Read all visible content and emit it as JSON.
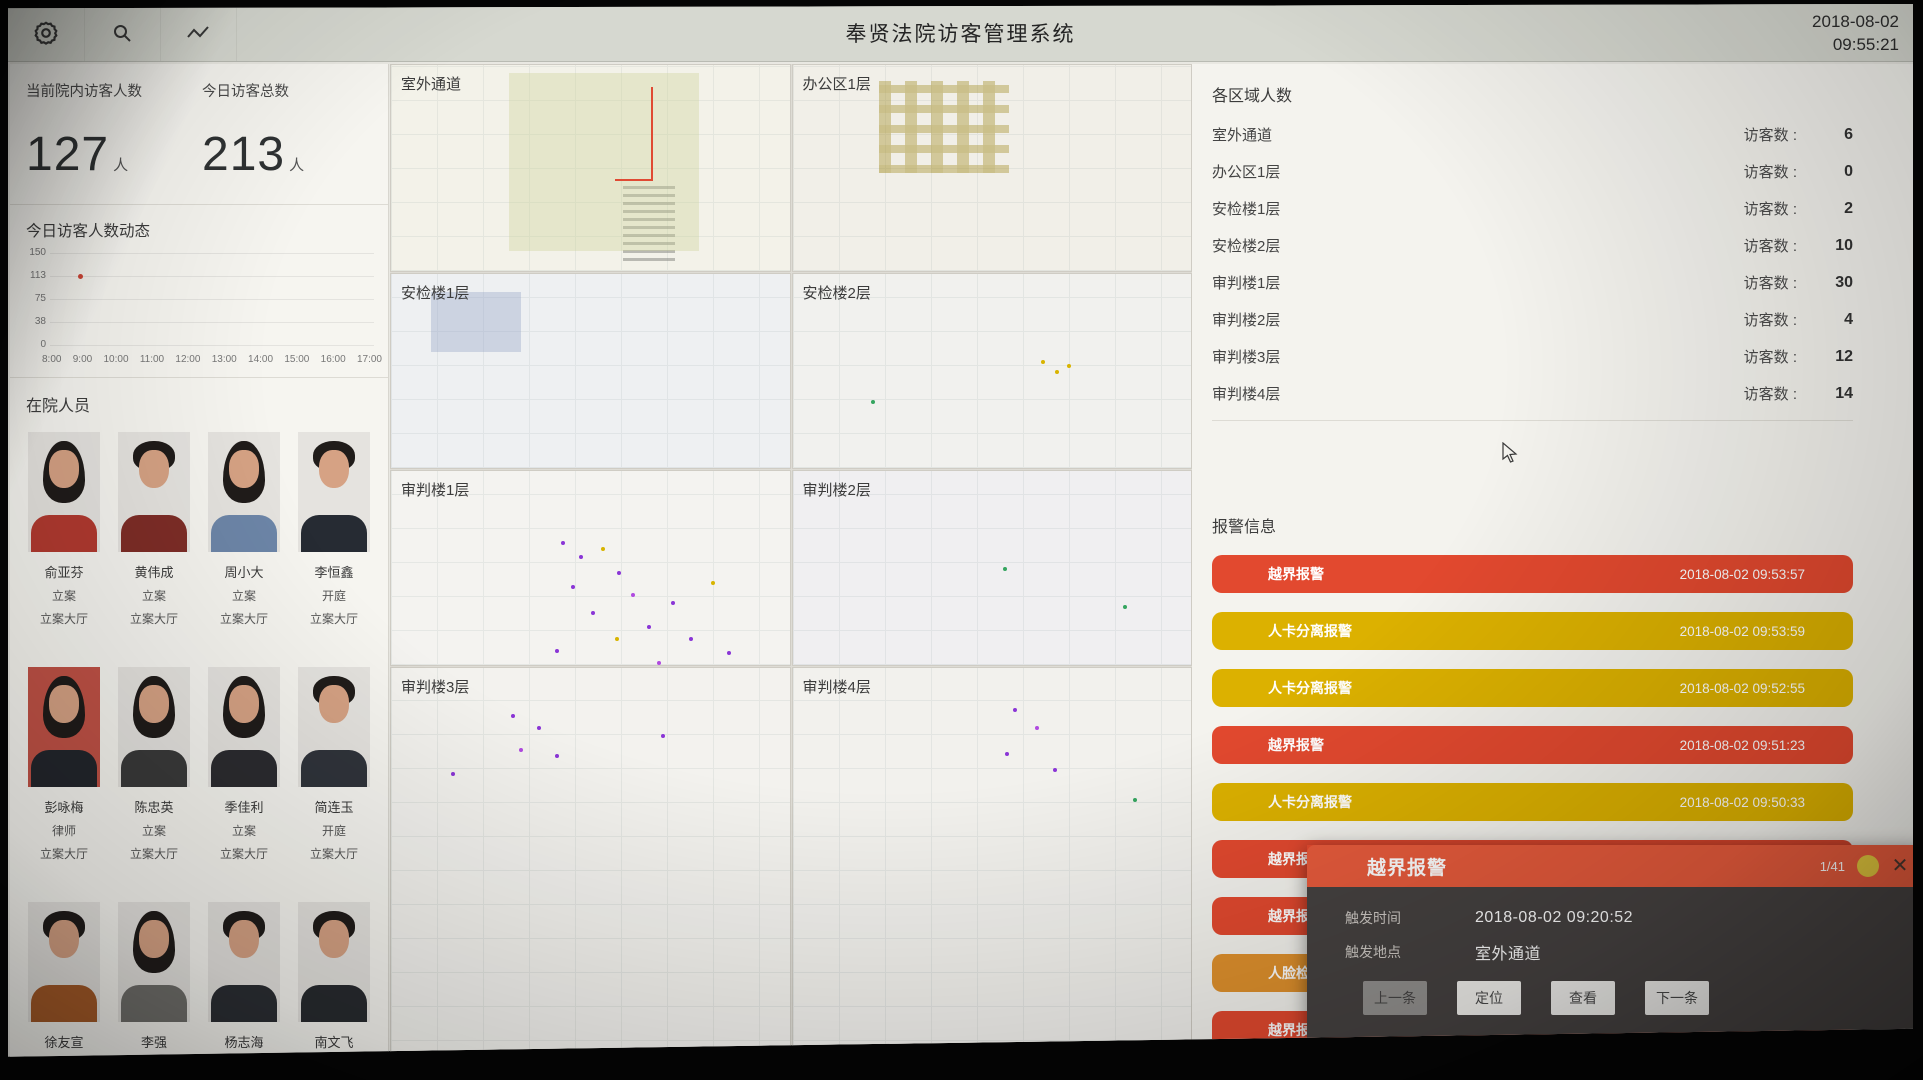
{
  "header": {
    "title": "奉贤法院访客管理系统",
    "date": "2018-08-02",
    "time": "09:55:21",
    "icons": [
      "settings-icon",
      "search-icon",
      "trend-icon"
    ]
  },
  "stats": {
    "current_label": "当前院内访客人数",
    "current_value": "127",
    "current_unit": "人",
    "today_label": "今日访客总数",
    "today_value": "213",
    "today_unit": "人"
  },
  "chart_data": {
    "type": "scatter",
    "title": "今日访客人数动态",
    "x_ticks": [
      "8:00",
      "9:00",
      "10:00",
      "11:00",
      "12:00",
      "13:00",
      "14:00",
      "15:00",
      "16:00",
      "17:00"
    ],
    "y_ticks": [
      "150",
      "113",
      "75",
      "38",
      "0"
    ],
    "ylim": [
      0,
      150
    ],
    "points": [
      {
        "x": "8:30",
        "y": 113
      }
    ],
    "grid": true,
    "legend": false
  },
  "personnel": {
    "title": "在院人员",
    "people": [
      {
        "name": "俞亚芬",
        "type": "立案",
        "location": "立案大厅"
      },
      {
        "name": "黄伟成",
        "type": "立案",
        "location": "立案大厅"
      },
      {
        "name": "周小大",
        "type": "立案",
        "location": "立案大厅"
      },
      {
        "name": "李恒鑫",
        "type": "开庭",
        "location": "立案大厅"
      },
      {
        "name": "彭咏梅",
        "type": "律师",
        "location": "立案大厅"
      },
      {
        "name": "陈忠英",
        "type": "立案",
        "location": "立案大厅"
      },
      {
        "name": "季佳利",
        "type": "立案",
        "location": "立案大厅"
      },
      {
        "name": "简连玉",
        "type": "开庭",
        "location": "立案大厅"
      },
      {
        "name": "徐友宣",
        "type": "立案",
        "location": ""
      },
      {
        "name": "李强",
        "type": "立案",
        "location": ""
      },
      {
        "name": "杨志海",
        "type": "开庭",
        "location": ""
      },
      {
        "name": "南文飞",
        "type": "立案",
        "location": ""
      }
    ]
  },
  "maps": {
    "panels": [
      {
        "label": "室外通道"
      },
      {
        "label": "办公区1层"
      },
      {
        "label": "安检楼1层"
      },
      {
        "label": "安检楼2层"
      },
      {
        "label": "审判楼1层"
      },
      {
        "label": "审判楼2层"
      },
      {
        "label": "审判楼3层"
      },
      {
        "label": "审判楼4层"
      }
    ]
  },
  "areas": {
    "title": "各区域人数",
    "count_label": "访客数 :",
    "rows": [
      {
        "name": "室外通道",
        "count": 6
      },
      {
        "name": "办公区1层",
        "count": 0
      },
      {
        "name": "安检楼1层",
        "count": 2
      },
      {
        "name": "安检楼2层",
        "count": 10
      },
      {
        "name": "审判楼1层",
        "count": 30
      },
      {
        "name": "审判楼2层",
        "count": 4
      },
      {
        "name": "审判楼3层",
        "count": 12
      },
      {
        "name": "审判楼4层",
        "count": 14
      }
    ]
  },
  "alarms": {
    "title": "报警信息",
    "items": [
      {
        "type": "越界报警",
        "time": "2018-08-02 09:53:57",
        "level": "red"
      },
      {
        "type": "人卡分离报警",
        "time": "2018-08-02 09:53:59",
        "level": "yellow"
      },
      {
        "type": "人卡分离报警",
        "time": "2018-08-02 09:52:55",
        "level": "yellow"
      },
      {
        "type": "越界报警",
        "time": "2018-08-02 09:51:23",
        "level": "red"
      },
      {
        "type": "人卡分离报警",
        "time": "2018-08-02 09:50:33",
        "level": "yellow"
      },
      {
        "type": "越界报警",
        "time": "",
        "level": "red"
      },
      {
        "type": "越界报警",
        "time": "",
        "level": "red"
      },
      {
        "type": "人脸检测报警",
        "time": "",
        "level": "orange"
      },
      {
        "type": "越界报警",
        "time": "",
        "level": "red"
      }
    ]
  },
  "popup": {
    "title": "越界报警",
    "counter": "1/41",
    "fields": [
      {
        "label": "触发时间",
        "value": "2018-08-02 09:20:52"
      },
      {
        "label": "触发地点",
        "value": "室外通道"
      }
    ],
    "buttons": [
      "上一条",
      "定位",
      "查看",
      "下一条"
    ]
  },
  "colors": {
    "alarm_red": "#e2492f",
    "alarm_yellow": "#dcb100",
    "alarm_orange": "#e0912d",
    "popup_header": "#e75b3c",
    "popup_body": "#464241",
    "chart_dot": "#cf4637"
  }
}
